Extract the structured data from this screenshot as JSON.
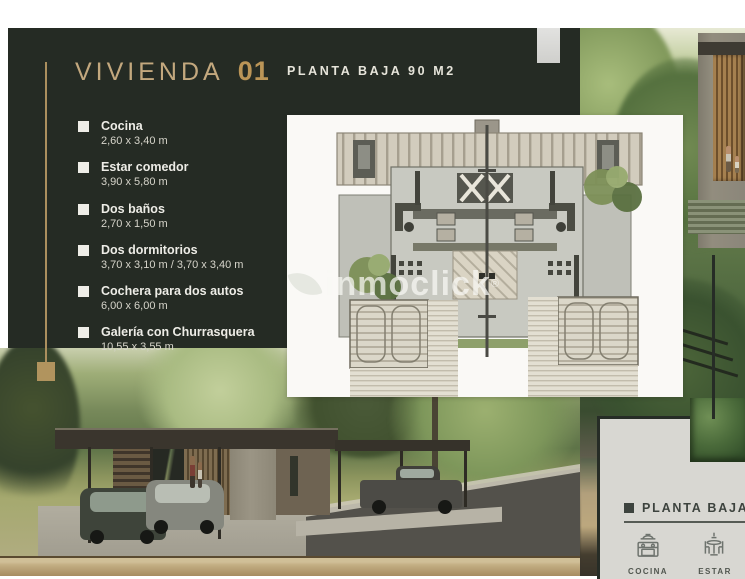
{
  "brochure": {
    "unit_title": "VIVIENDA",
    "unit_number": "01",
    "subtitle": "PLANTA BAJA 90 M2",
    "features": [
      {
        "label": "Cocina",
        "dims": "2,60 x 3,40 m"
      },
      {
        "label": "Estar comedor",
        "dims": "3,90 x 5,80 m"
      },
      {
        "label": "Dos baños",
        "dims": "2,70 x 1,50 m"
      },
      {
        "label": "Dos dormitorios",
        "dims": "3,70 x 3,10 m / 3,70 x 3,40 m"
      },
      {
        "label": "Cochera para dos autos",
        "dims": "6,00 x 6,00 m"
      },
      {
        "label": "Galería con Churrasquera",
        "dims": "10,55 x 3,55 m"
      }
    ],
    "watermark": {
      "text": "inmoclick",
      "mark": "®",
      "icon": "leaf-icon"
    }
  },
  "next_page": {
    "section_title": "PLANTA BAJA",
    "legend": [
      {
        "icon": "kitchen-stove-icon",
        "label": "COCINA"
      },
      {
        "icon": "dining-table-icon",
        "label": "ESTAR"
      }
    ]
  },
  "colors": {
    "panel_dark_green": "#252b24",
    "accent_gold": "#bb9557",
    "accent_tan": "#c3a87e",
    "card_bg": "#d8d7d2",
    "card_ink": "#3d433e",
    "tan_band": "#c3ae83",
    "plan_paper": "#faf9f6"
  }
}
